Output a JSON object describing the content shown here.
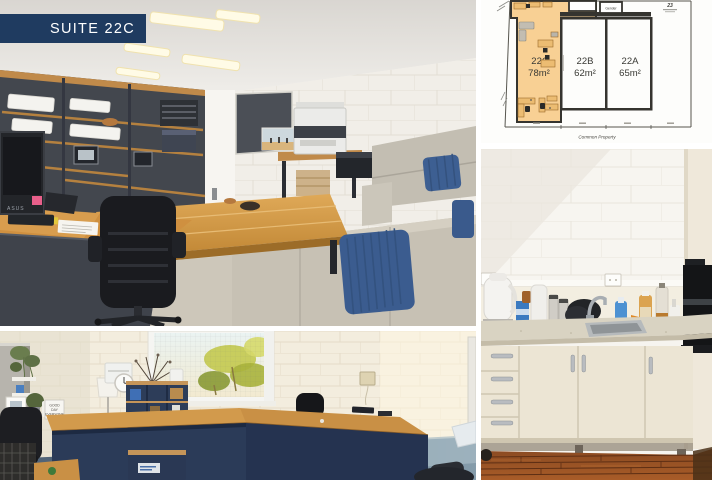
{
  "collage": {
    "background": "#ffffff",
    "gutter_px": 5
  },
  "badge": {
    "label": "SUITE 22C",
    "background_color": "#1f3b60",
    "text_color": "#ffffff"
  },
  "floor_plan": {
    "highlight_color": "#f8d094",
    "suites": [
      {
        "id": "22C",
        "area": "78m²",
        "highlighted": true
      },
      {
        "id": "22B",
        "area": "62m²",
        "highlighted": false
      },
      {
        "id": "22A",
        "area": "65m²",
        "highlighted": false
      }
    ],
    "common_property_label": "Common Property",
    "lot_number": "23",
    "small_room_label": "Gender"
  },
  "main_photo": {
    "monitor_brand": "ASUS"
  },
  "second_office_photo": {
    "letter_board_lines": [
      "GOOD",
      "DAY",
      "EVERYONE"
    ]
  }
}
